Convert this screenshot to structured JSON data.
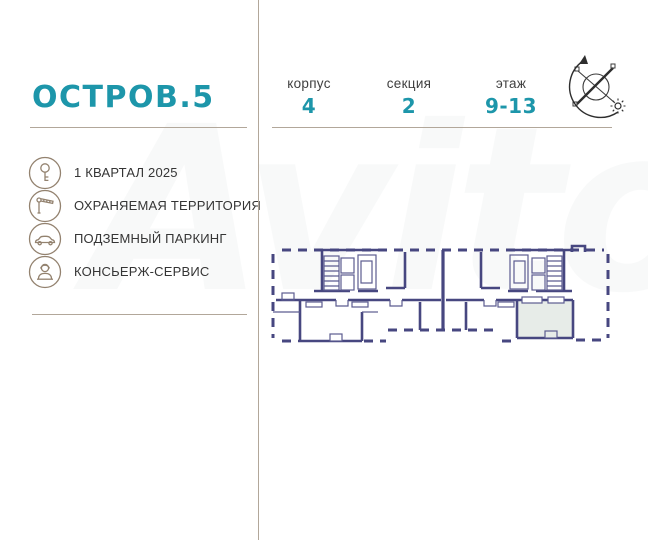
{
  "brand": {
    "logo": "ОСТРОВ.5"
  },
  "header": {
    "specs": [
      {
        "label": "корпус",
        "value": "4"
      },
      {
        "label": "секция",
        "value": "2"
      },
      {
        "label": "этаж",
        "value": "9-13"
      }
    ],
    "compass_icon": "compass-north-arrow-with-sun"
  },
  "features": [
    {
      "icon": "key-icon",
      "label": "1 КВАРТАЛ 2025"
    },
    {
      "icon": "barrier-icon",
      "label": "ОХРАНЯЕМАЯ ТЕРРИТОРИЯ"
    },
    {
      "icon": "car-icon",
      "label": "ПОДЗЕМНЫЙ ПАРКИНГ"
    },
    {
      "icon": "concierge-icon",
      "label": "КОНСЬЕРЖ-СЕРВИС"
    }
  ],
  "floor_plan": {
    "type": "blueprint-section-plan",
    "highlighted_unit": true,
    "description": "floor plan of section 2 with one highlighted apartment"
  },
  "watermark": "Avito",
  "colors": {
    "accent_teal": "#1d96aa",
    "divider_tan": "#b2a79a",
    "icon_brown": "#93826f",
    "wall_navy": "#474780",
    "highlight_fill": "#e7ece8",
    "label_gray": "#3f3f3f"
  }
}
